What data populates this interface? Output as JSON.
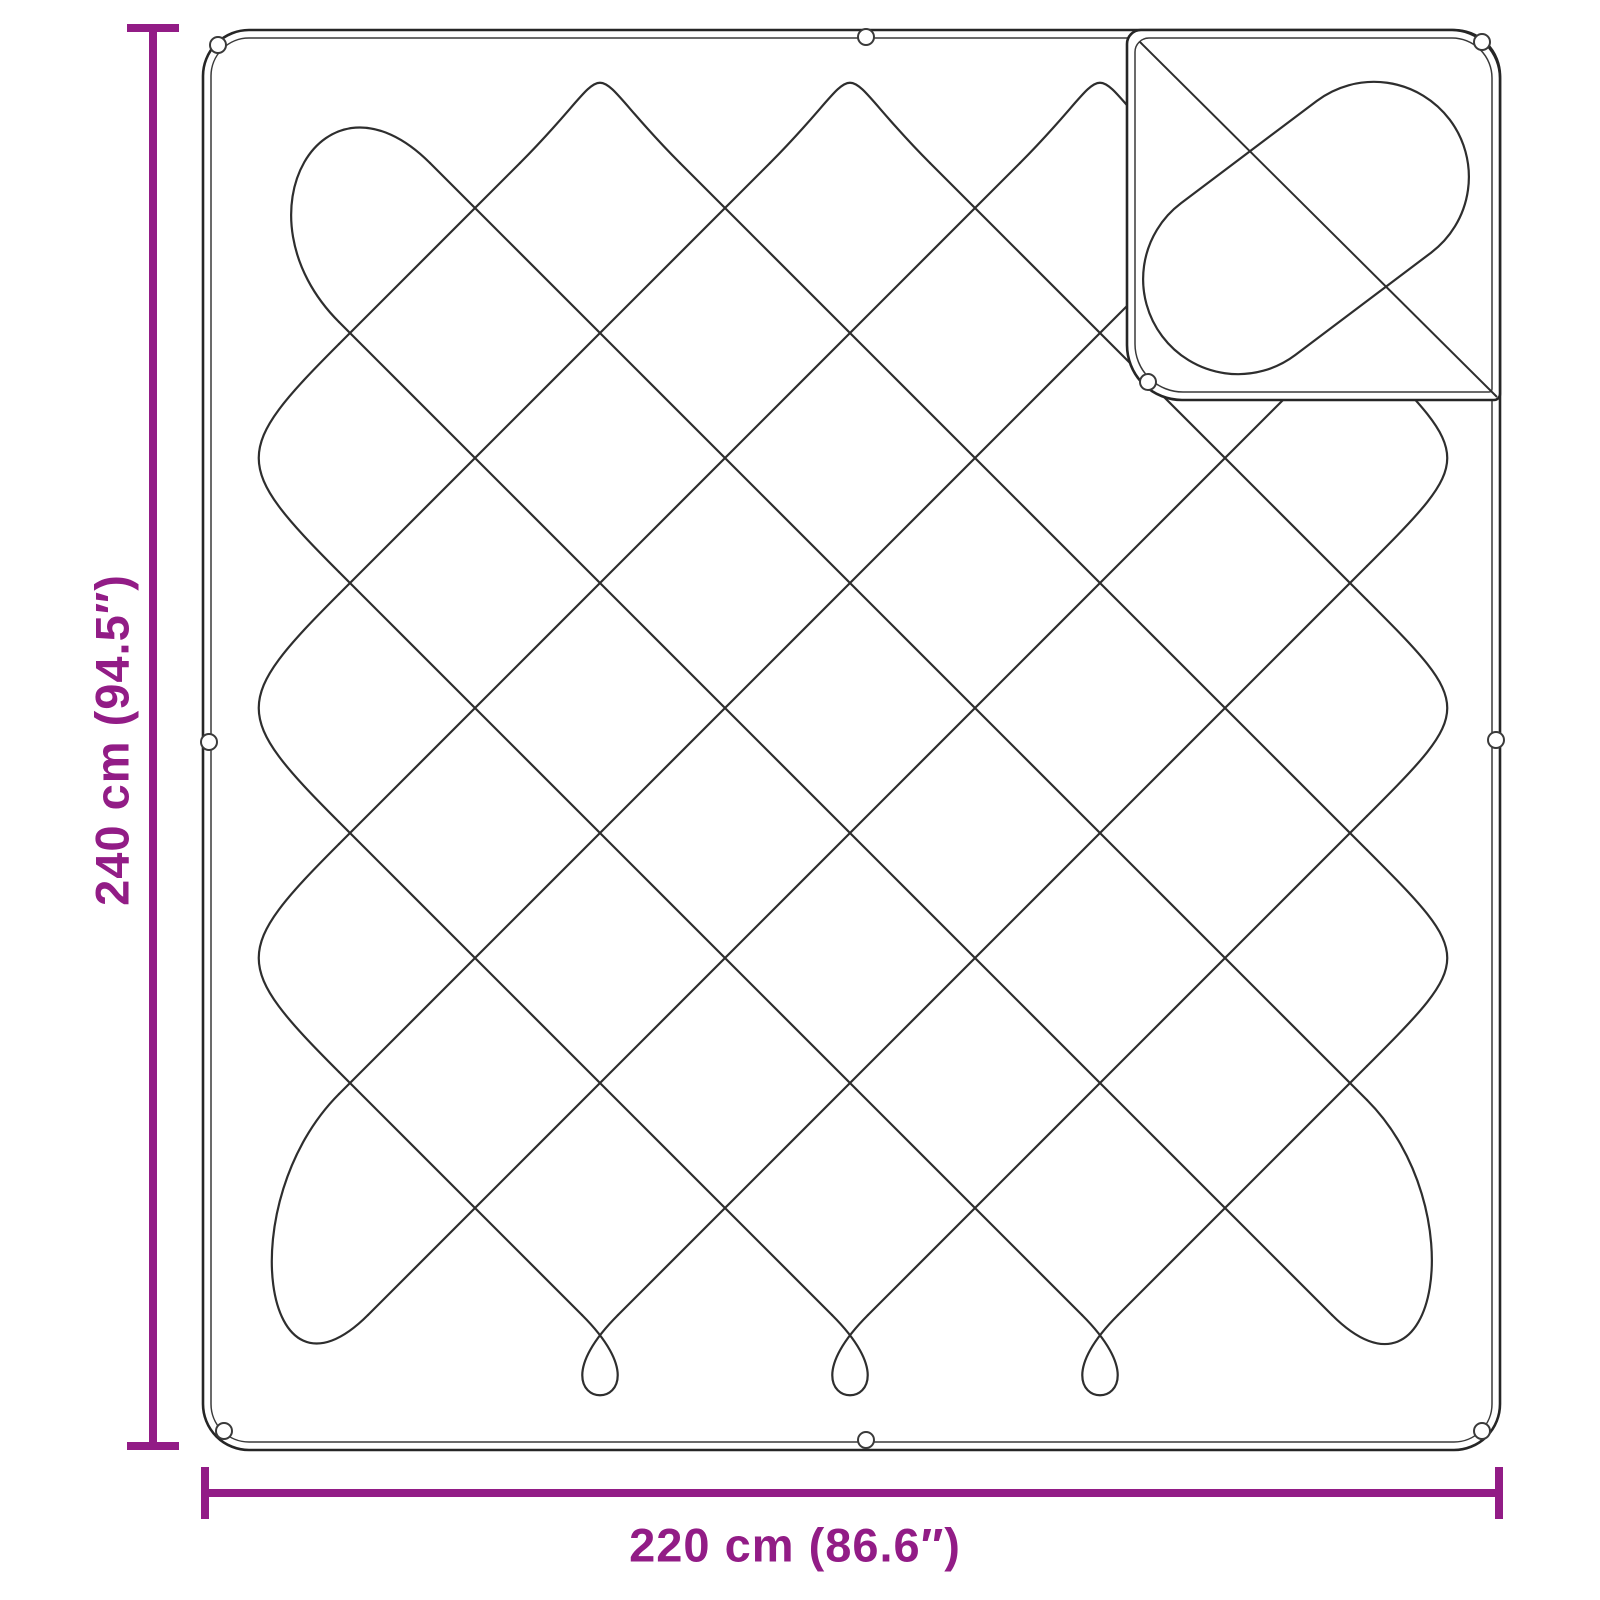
{
  "diagram": {
    "subject": "quilted blanket with folded corner flap",
    "dimensions": {
      "height": {
        "label": "240 cm (94.5″)"
      },
      "width": {
        "label": "220 cm (86.6″)"
      }
    },
    "colors": {
      "dimension_accent": "#921C86",
      "outline": "#262626",
      "background": "#ffffff"
    },
    "snap_button_count": 9
  }
}
